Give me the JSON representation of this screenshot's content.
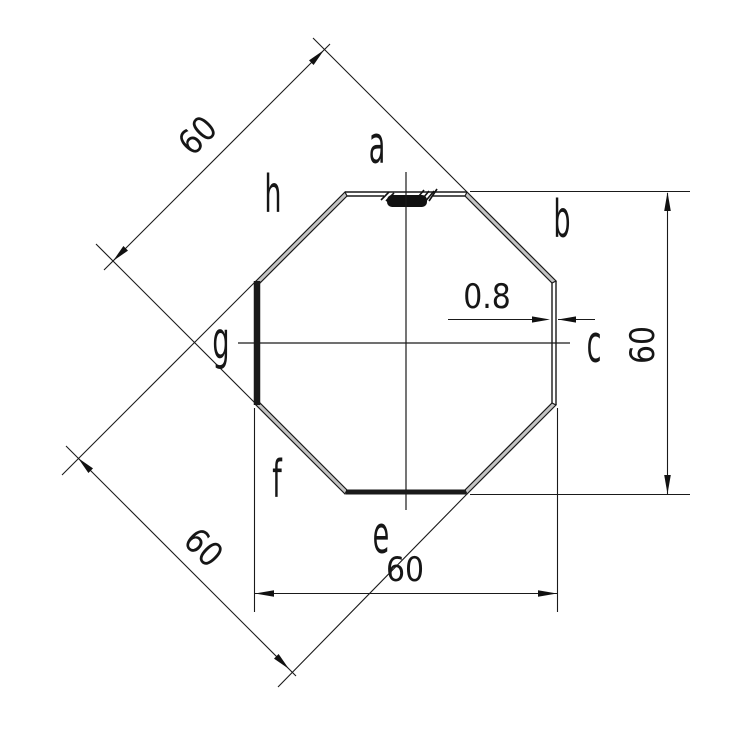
{
  "drawing": {
    "kind": "octagonal-tube-cross-section",
    "colors": {
      "background": "#ffffff",
      "line": "#1a1a1a",
      "wall_hatch_fill": "#c4c4c4",
      "seam_fill": "#111111"
    },
    "side_labels": {
      "top": "a",
      "upper_right": "b",
      "right": "c",
      "bottom": "e",
      "lower_left": "f",
      "left": "g",
      "upper_left": "h"
    },
    "dimensions": {
      "height_across_flats": "60",
      "width_across_flats": "60",
      "diagonal_upper_across_flats": "60",
      "diagonal_lower_across_flats": "60",
      "wall_thickness": "0.8"
    }
  }
}
